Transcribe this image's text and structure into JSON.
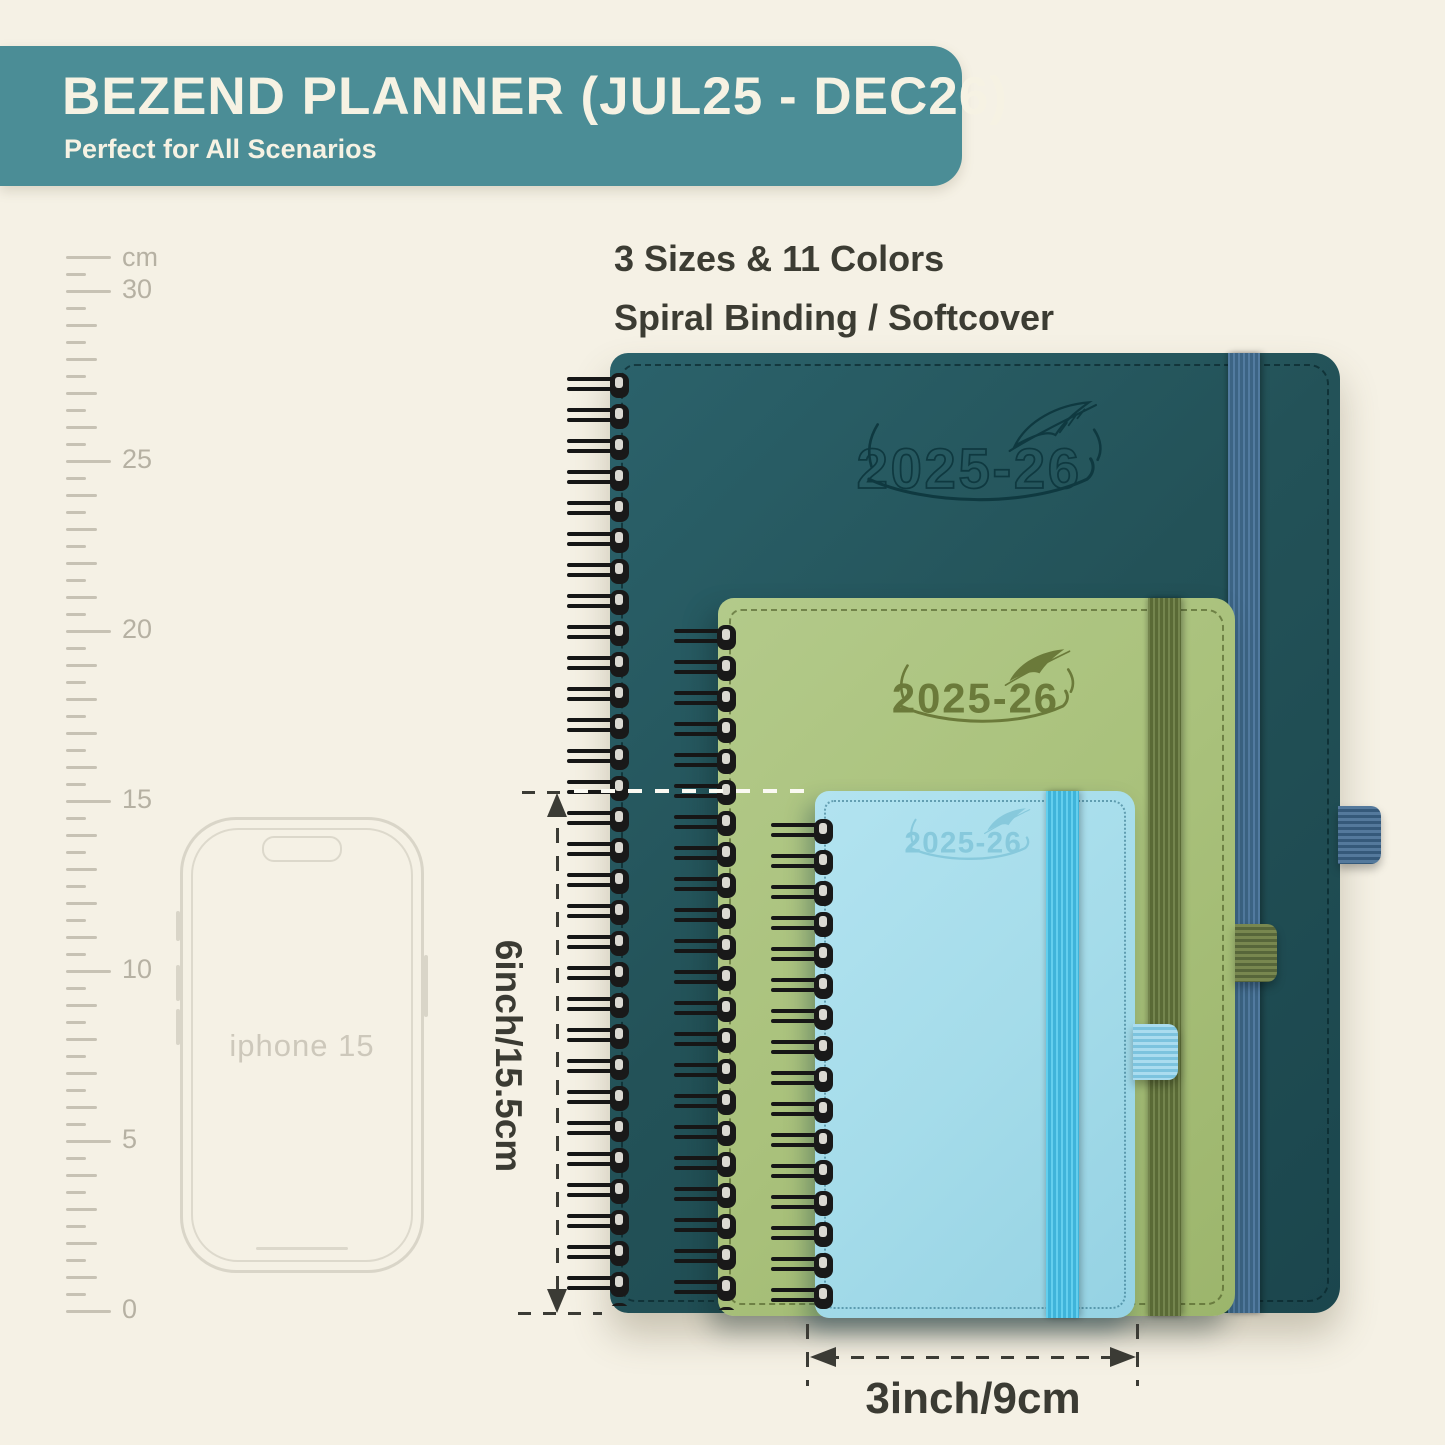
{
  "header": {
    "title": "BEZEND PLANNER (JUL25 - DEC26)",
    "subtitle": "Perfect for All Scenarios"
  },
  "info": {
    "line1": "3 Sizes & 11 Colors",
    "line2": "Spiral Binding / Softcover"
  },
  "ruler": {
    "unit": "cm",
    "labels": [
      "30",
      "25",
      "20",
      "15",
      "10",
      "5",
      "0"
    ]
  },
  "phone": {
    "label": "iphone 15"
  },
  "planners": {
    "large": {
      "year": "2025-26",
      "cover_color": "#24545b",
      "band_color": "#47708f"
    },
    "medium": {
      "year": "2025-26",
      "cover_color": "#a9c17b",
      "band_color": "#6b7b44"
    },
    "small": {
      "year": "2025-26",
      "cover_color": "#a5dcea",
      "band_color": "#4fc3e8"
    }
  },
  "dimensions": {
    "height_label": "6inch/15.5cm",
    "width_label": "3inch/9cm"
  },
  "palette": {
    "background": "#f5f1e5",
    "banner": "#4b8d96",
    "banner_text": "#f6f2e3",
    "annotation": "#3b3b34",
    "spiral": "#161616"
  }
}
